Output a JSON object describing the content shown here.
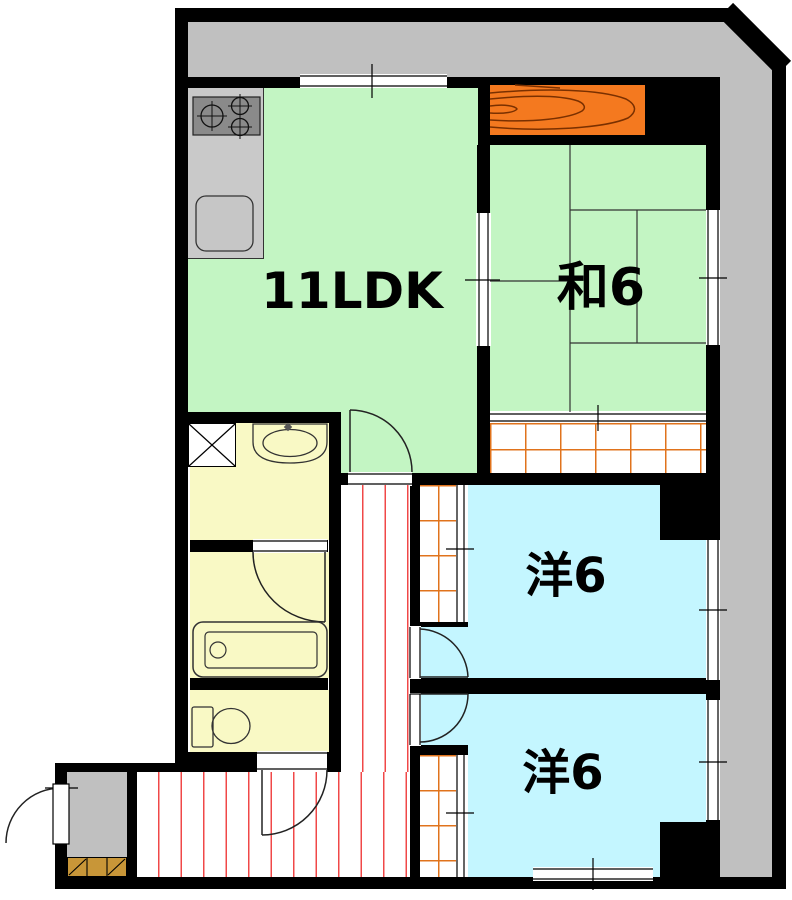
{
  "title": "apartment-floor-plan",
  "rooms": {
    "ldk": {
      "label": "11LDK"
    },
    "japanese": {
      "label": "和6"
    },
    "western_upper": {
      "label": "洋6"
    },
    "western_lower": {
      "label": "洋6"
    }
  },
  "fixtures": {
    "stove": "gas-stove-3-burner",
    "kitchen_sink": "kitchen-sink",
    "washing_machine": "washing-machine-pan",
    "washbasin": "washbasin",
    "bathtub": "bathtub",
    "toilet": "toilet",
    "futon_closet": "futon-storage",
    "shoe_cabinet": "shoe-cabinet"
  },
  "colors": {
    "room_green": "#c3f5c3",
    "room_cyan": "#c4f6ff",
    "room_yellow": "#f9f9c5",
    "balcony_gray": "#c0c0c0",
    "futon_orange": "#f4791f",
    "corridor_stripe": "#f04848",
    "closet_grid": "#e0731c",
    "wall": "#000000"
  }
}
